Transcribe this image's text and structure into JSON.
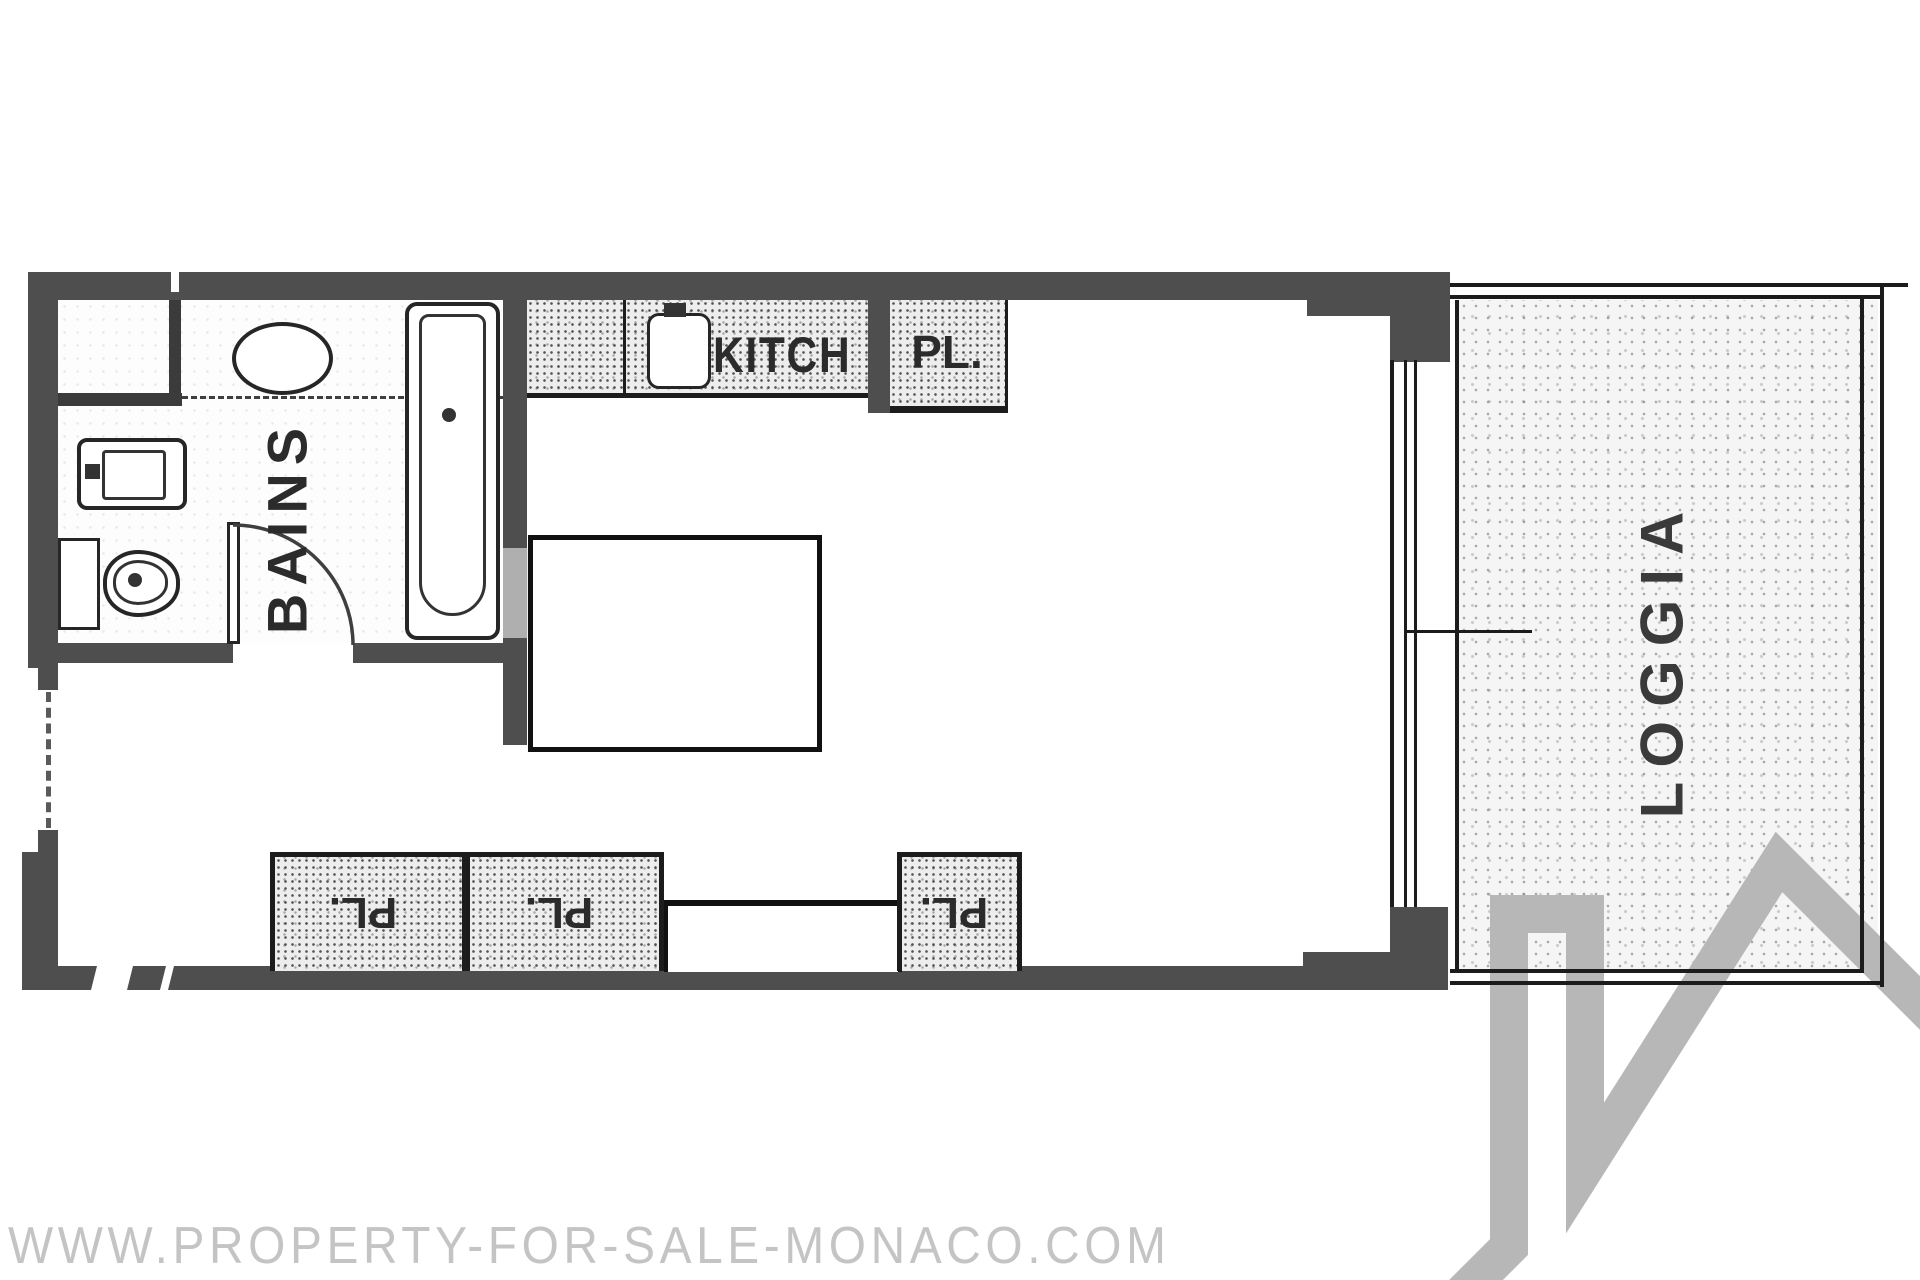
{
  "canvas": {
    "width": 1920,
    "height": 1280,
    "background": "#ffffff"
  },
  "colors": {
    "wall": "#4e4e4e",
    "line": "#1c1c1c",
    "label": "#2b2b2b",
    "logo": "#b7b7b7",
    "wm": "#c4c4c4"
  },
  "labels": {
    "bathroom": "BAINS",
    "kitchen": "KITCH",
    "closet_top": "PL.",
    "closet_bottom_left": "PL.",
    "closet_bottom_mid": "PL.",
    "closet_bottom_right": "PL.",
    "loggia": "LOGGIA"
  },
  "watermark": {
    "text": "WWW.PROPERTY-FOR-SALE-MONACO.COM"
  },
  "icons": {
    "logo": "house-roof-logo",
    "fixtures": [
      "bathtub",
      "washbasin",
      "toilet",
      "oval-basin",
      "kitchen-sink"
    ]
  }
}
